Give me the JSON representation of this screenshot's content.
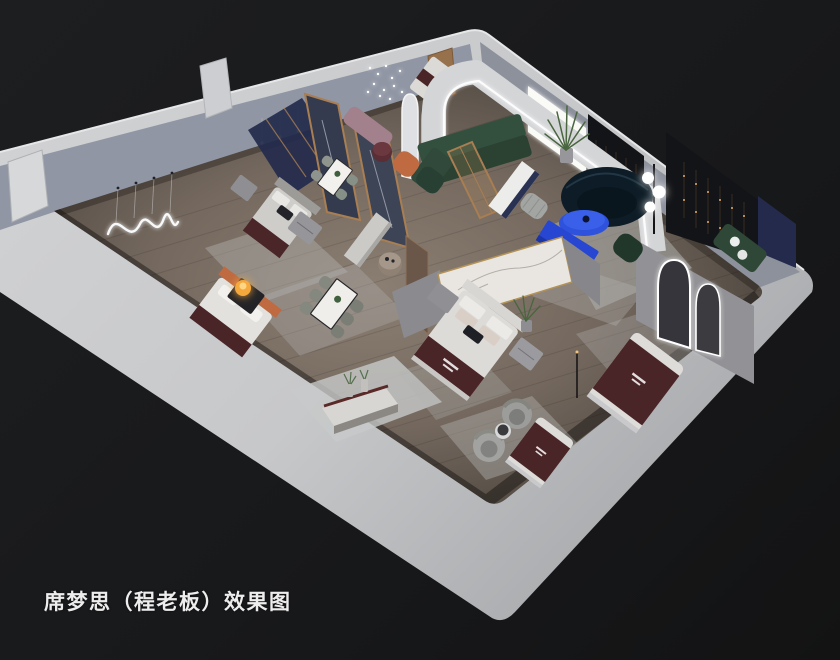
{
  "caption": {
    "text": "席梦思（程老板）效果图"
  },
  "scene": {
    "type": "3d-interior-cutaway-render",
    "objects": [
      "arched-led-feature-wall",
      "green-sectional-sofa",
      "navy-round-sofa",
      "blue-oval-coffee-table",
      "blue-console",
      "display-bed-with-brand-runner",
      "marble-partition",
      "dining-table-set",
      "arched-mirror",
      "copper-string-light-art",
      "led-squiggle-wall-art",
      "swivel-chair",
      "globe-floor-lamp",
      "potted-plant",
      "nightstand",
      "terracotta-bed",
      "wood-frame-mirror-partition",
      "display-cabinet"
    ]
  },
  "colors": {
    "caption-text": "#ededee",
    "background-dark": "#18191b",
    "outer-wall": "#c9cacc",
    "inner-wall": "#9096a4",
    "floor-wood": "#75695f",
    "brand-maroon": "#4a2527",
    "accent-blue": "#2e52dc",
    "sofa-green": "#33503e",
    "sofa-navy": "#0d1c26",
    "wood-trim": "#a87e52",
    "led-white": "#ffffff",
    "lamp-amber": "#f5a93e",
    "rug-gray": "#b4b5b3",
    "charcoal-panel": "#131417",
    "navy-panel": "#232a4c",
    "terracotta": "#bf6a40",
    "marble": "#e9e6e1"
  }
}
